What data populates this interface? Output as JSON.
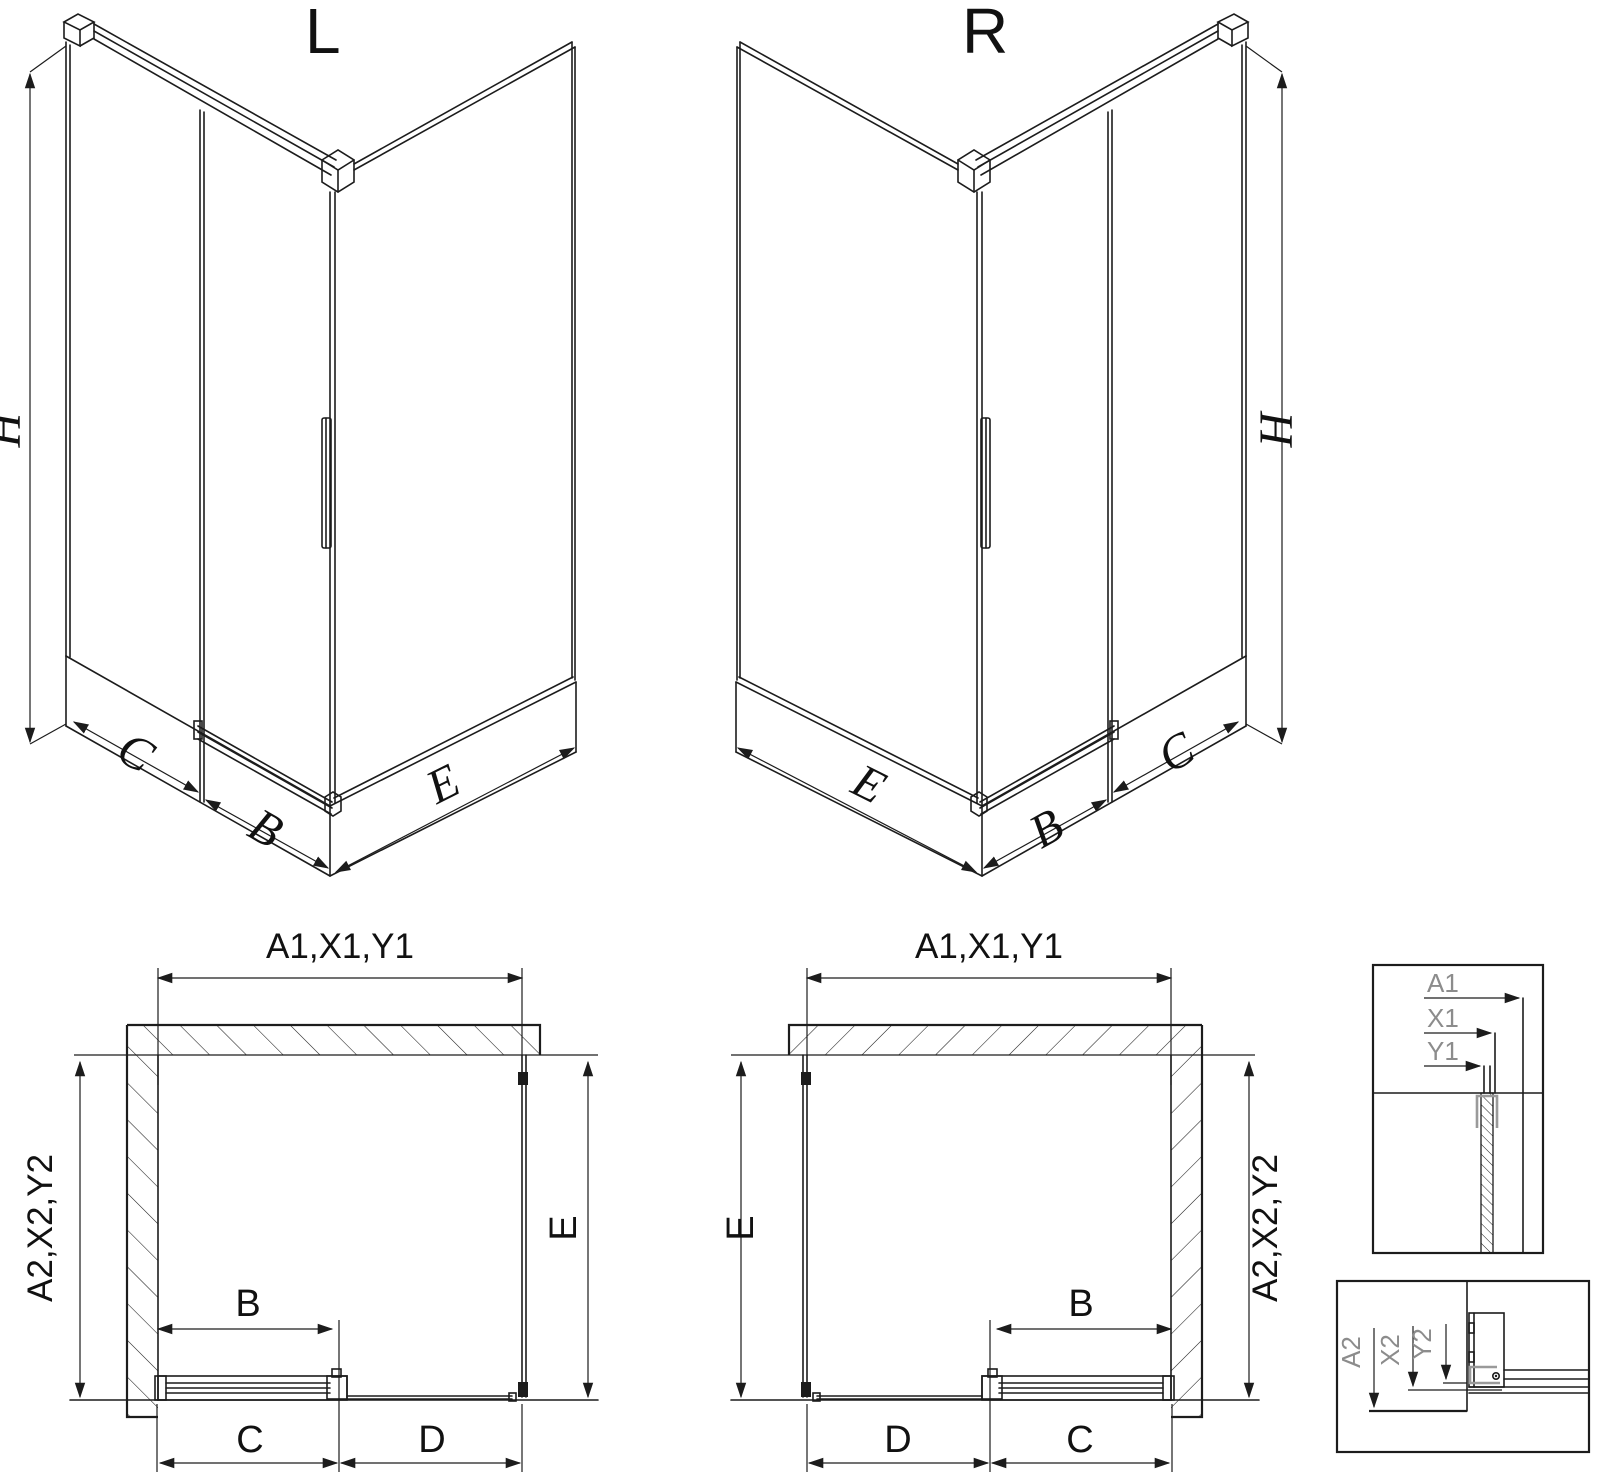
{
  "diagram": {
    "iso_left": {
      "label": "L",
      "dim_h": "H",
      "dim_c": "C",
      "dim_b": "B",
      "dim_e": "E"
    },
    "iso_right": {
      "label": "R",
      "dim_h": "H",
      "dim_c": "C",
      "dim_b": "B",
      "dim_e": "E"
    },
    "plan_left": {
      "dim_top": "A1,X1,Y1",
      "dim_side": "A2,X2,Y2",
      "dim_e": "E",
      "dim_b": "B",
      "dim_c": "C",
      "dim_d": "D"
    },
    "plan_right": {
      "dim_top": "A1,X1,Y1",
      "dim_side": "A2,X2,Y2",
      "dim_e": "E",
      "dim_b": "B",
      "dim_c": "C",
      "dim_d": "D"
    },
    "detail_top": {
      "dim_a1": "A1",
      "dim_x1": "X1",
      "dim_y1": "Y1"
    },
    "detail_bottom": {
      "dim_a2": "A2",
      "dim_x2": "X2",
      "dim_y2": "Y2"
    }
  },
  "colors": {
    "line": "#1c1c1c",
    "accent_gray": "#8c8c8c",
    "background": "#ffffff"
  }
}
